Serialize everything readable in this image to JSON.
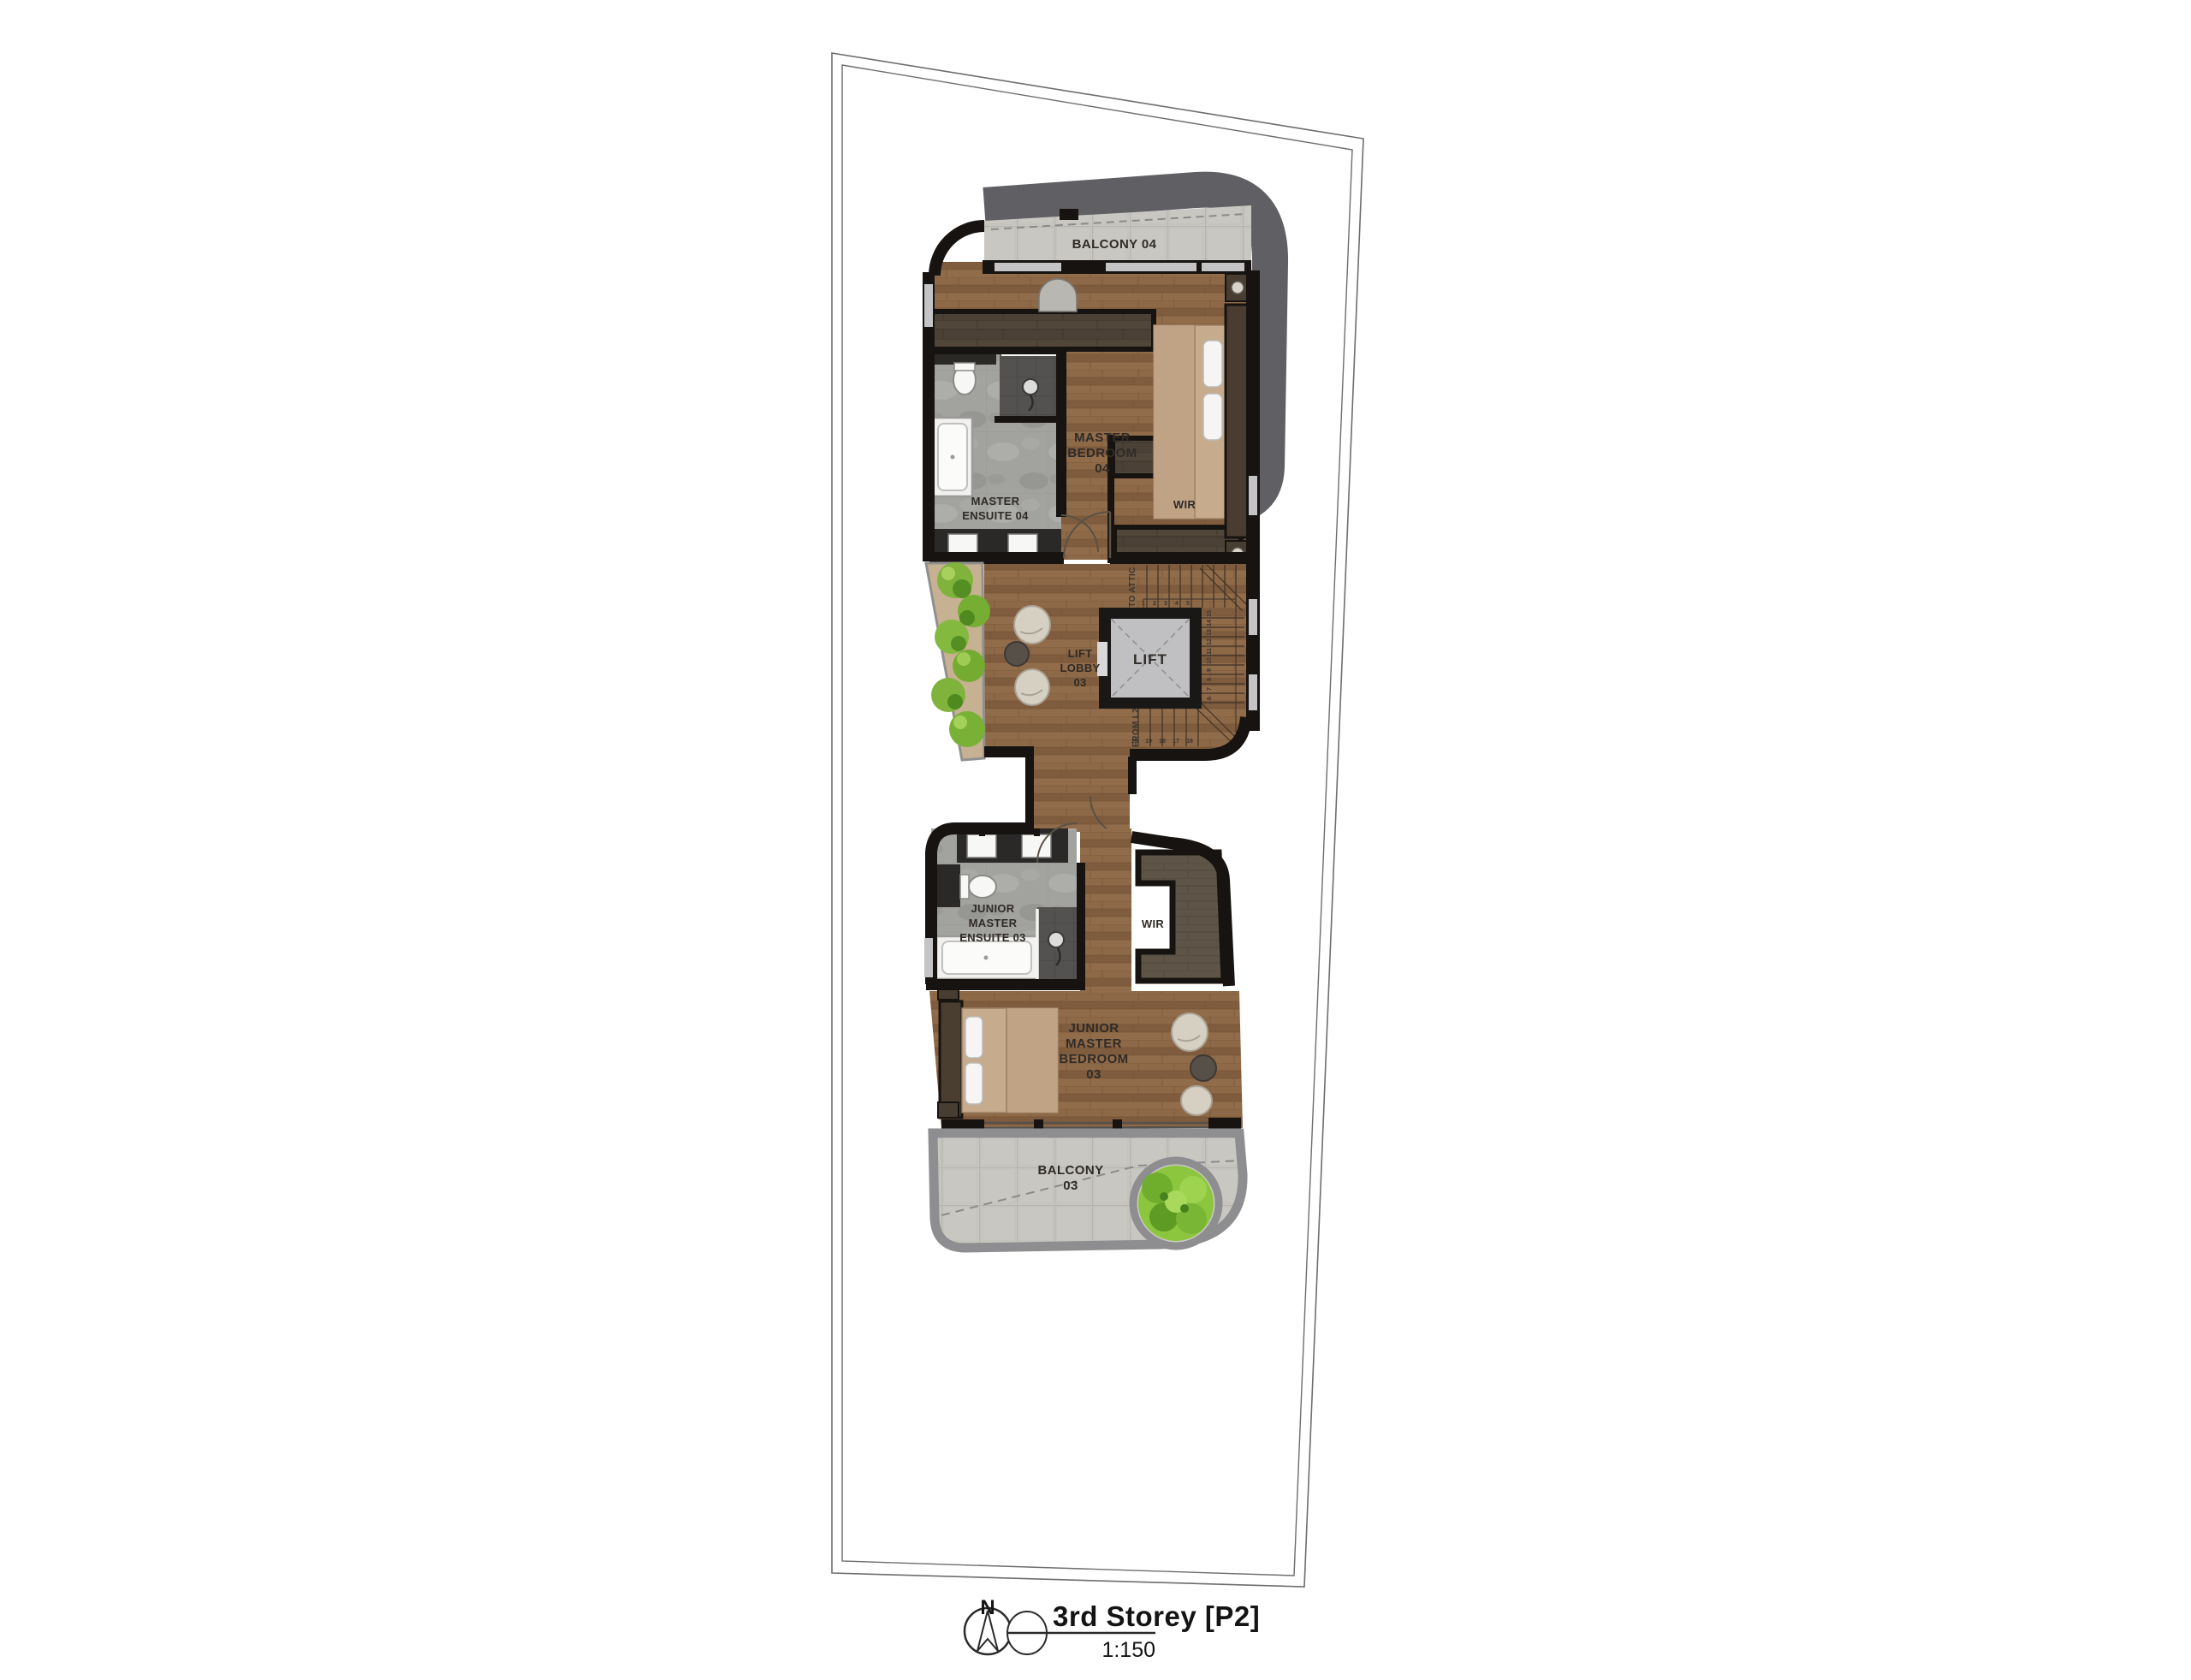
{
  "plan": {
    "sheet_title": "3rd Storey [P2]",
    "sheet_scale": "1:150",
    "north_label": "N",
    "labels": {
      "balcony04": [
        "BALCONY 04"
      ],
      "master_bedroom04": [
        "MASTER",
        "BEDROOM",
        "04"
      ],
      "master_ensuite04": [
        "MASTER",
        "ENSUITE 04"
      ],
      "wir04": "WIR",
      "lift": "LIFT",
      "lift_lobby03": [
        "LIFT",
        "LOBBY",
        "03"
      ],
      "junior_master_ensuite03": [
        "JUNIOR",
        "MASTER",
        "ENSUITE 03"
      ],
      "wir03": "WIR",
      "junior_master_bedroom03": [
        "JUNIOR",
        "MASTER",
        "BEDROOM",
        "03"
      ],
      "balcony03": [
        "BALCONY",
        "03"
      ]
    },
    "stairs": {
      "to_attic": "TO ATTIC",
      "from_l2": "FROM L2",
      "top_numbers": [
        "1",
        "2",
        "3",
        "4",
        "5"
      ],
      "right_numbers": [
        "6",
        "7",
        "8",
        "9",
        "10",
        "11",
        "12",
        "13",
        "14",
        "15"
      ],
      "bottom_numbers": [
        "20",
        "19",
        "18",
        "17",
        "16"
      ]
    },
    "colors": {
      "wall": "#161310",
      "roof_band": "#606064",
      "wood": "#8a6544",
      "wardrobe": "#4c4136",
      "stone": "#c9c7c2",
      "marble": "#a2a29f",
      "lift_cab": "#c0c0c2",
      "shrub_green": "#8cc63e",
      "pouf_cream": "#d6d0c3",
      "mattress": "#c6ab8c",
      "label_ink": "#2f2b27"
    }
  }
}
